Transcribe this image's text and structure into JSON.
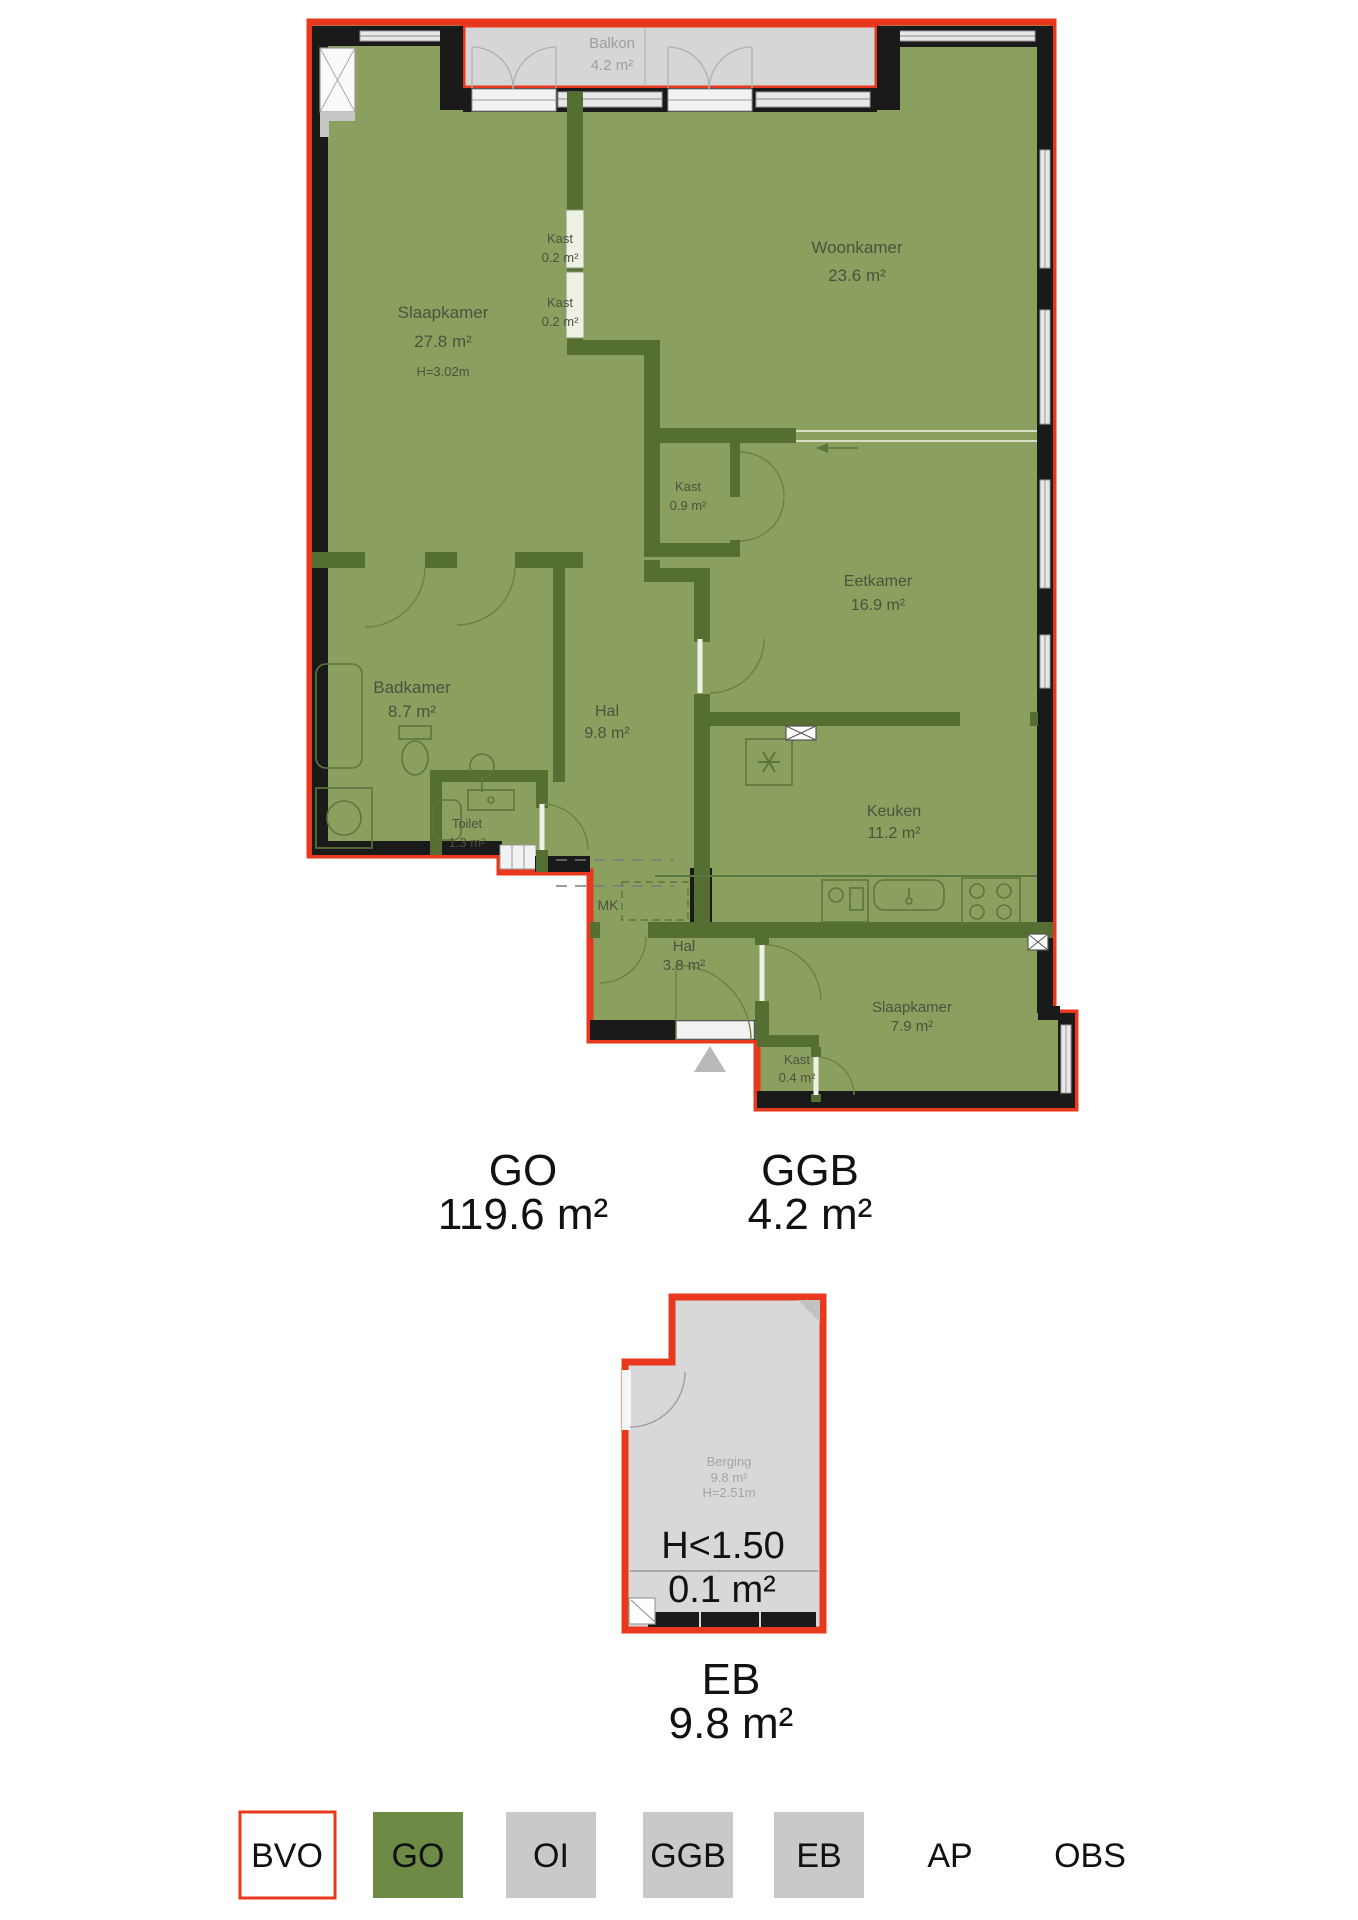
{
  "plan": {
    "rooms": {
      "balkon": {
        "name": "Balkon",
        "area": "4.2 m²"
      },
      "slaapkamer1": {
        "name": "Slaapkamer",
        "area": "27.8 m²",
        "height": "H=3.02m"
      },
      "kast_a": {
        "name": "Kast",
        "area": "0.2 m²"
      },
      "kast_b": {
        "name": "Kast",
        "area": "0.2 m²"
      },
      "woonkamer": {
        "name": "Woonkamer",
        "area": "23.6 m²"
      },
      "kast_c": {
        "name": "Kast",
        "area": "0.9 m²"
      },
      "eetkamer": {
        "name": "Eetkamer",
        "area": "16.9 m²"
      },
      "badkamer": {
        "name": "Badkamer",
        "area": "8.7 m²"
      },
      "hal1": {
        "name": "Hal",
        "area": "9.8 m²"
      },
      "toilet": {
        "name": "Toilet",
        "area": "1.3 m²"
      },
      "keuken": {
        "name": "Keuken",
        "area": "11.2 m²"
      },
      "mk": {
        "name": "MK"
      },
      "hal2": {
        "name": "Hal",
        "area": "3.8 m²"
      },
      "slaapkamer2": {
        "name": "Slaapkamer",
        "area": "7.9 m²"
      },
      "kast_d": {
        "name": "Kast",
        "area": "0.4 m²"
      }
    },
    "summary": {
      "go": {
        "label": "GO",
        "area": "119.6 m²"
      },
      "ggb": {
        "label": "GGB",
        "area": "4.2 m²"
      },
      "eb": {
        "label": "EB",
        "area": "9.8 m²"
      }
    },
    "eb_plan": {
      "room": {
        "name": "Berging",
        "area": "9.8 m²",
        "height": "H=2.51m"
      },
      "low_height_label": "H<1.50",
      "low_height_area": "0.1 m²"
    }
  },
  "legend": {
    "items": [
      {
        "label": "BVO",
        "style": "outline-red"
      },
      {
        "label": "GO",
        "style": "green"
      },
      {
        "label": "OI",
        "style": "gray"
      },
      {
        "label": "GGB",
        "style": "gray"
      },
      {
        "label": "EB",
        "style": "gray"
      },
      {
        "label": "AP",
        "style": "none"
      },
      {
        "label": "OBS",
        "style": "none"
      }
    ]
  },
  "colors": {
    "bvo_red": "#E8391E",
    "go_green_fill": "#8BA05E",
    "go_green_legend": "#6D8B45",
    "wall_dark_green": "#546F31",
    "wall_black": "#1A1A1A",
    "ggb_gray": "#D6D6D6",
    "eb_gray": "#D8D8D8",
    "legend_gray": "#C9C9C9"
  }
}
